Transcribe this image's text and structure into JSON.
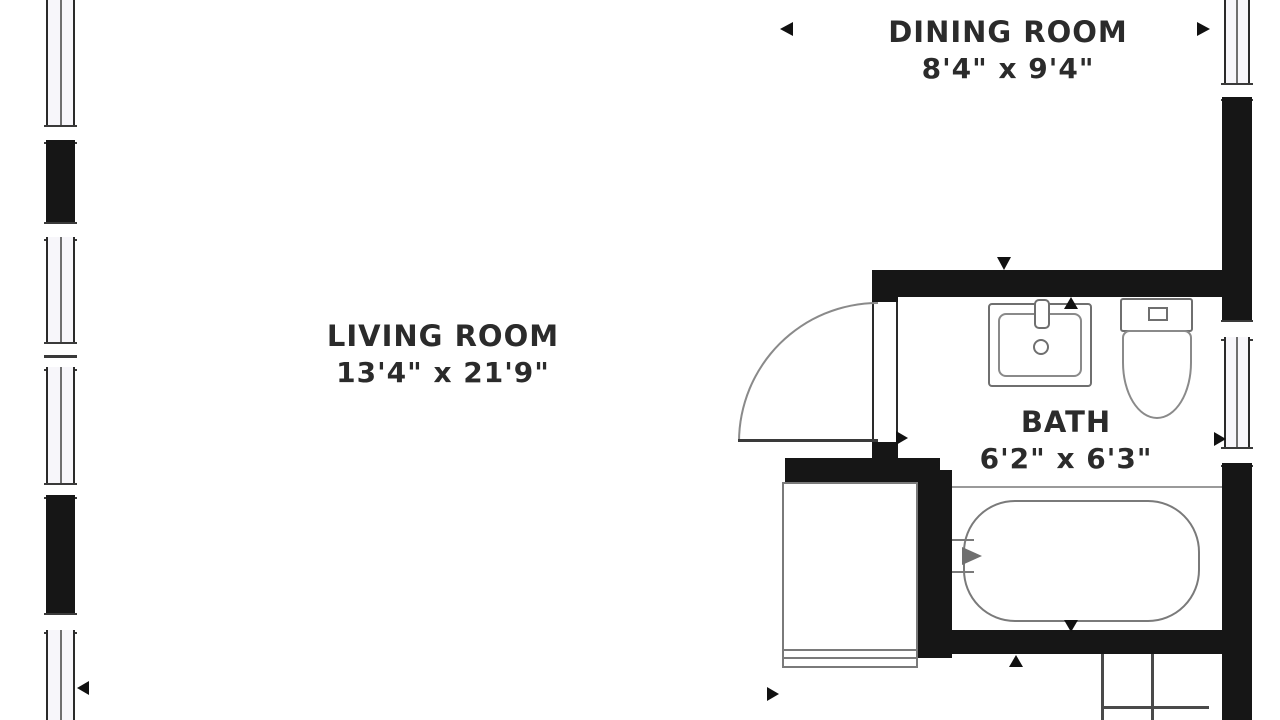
{
  "plan": {
    "type": "apartment-floor-plan",
    "background": "#ffffff",
    "colors": {
      "wall": "#161616",
      "window_fill": "#f7f6fa",
      "fixture_line": "#6f6f6f",
      "text": "#2b2b2b"
    },
    "rooms": [
      {
        "id": "dining-room",
        "name": "DINING ROOM",
        "dimensions": "8'4\" x 9'4\""
      },
      {
        "id": "living-room",
        "name": "LIVING ROOM",
        "dimensions": "13'4\" x 21'9\""
      },
      {
        "id": "bath",
        "name": "BATH",
        "dimensions": "6'2\" x 6'3\""
      }
    ],
    "fixtures": [
      "sink",
      "toilet",
      "bathtub",
      "washer-dryer",
      "door-swing",
      "closet-shelves",
      "windows"
    ],
    "direction_markers": [
      "left",
      "right",
      "down",
      "up",
      "right",
      "right",
      "down",
      "up",
      "left",
      "right"
    ]
  }
}
